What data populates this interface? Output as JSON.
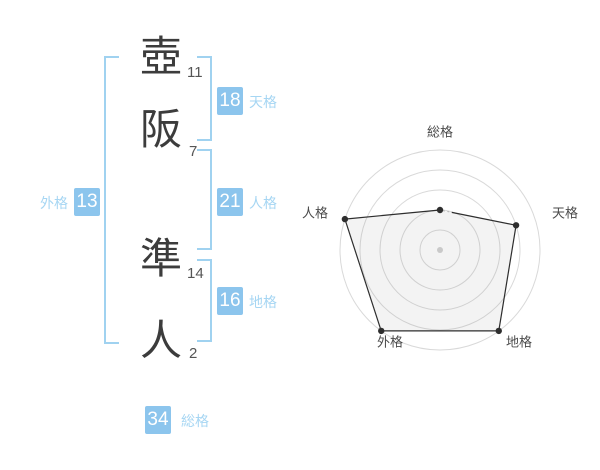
{
  "colors": {
    "accent": "#8cc5ed",
    "accent-light": "#a6d6f3",
    "bracket": "#a0d2f0",
    "ink": "#3c3c3c",
    "stroke-gray": "#555555",
    "axis-label": "#4a4a4a"
  },
  "name_analysis": {
    "characters": [
      {
        "char": "壺",
        "strokes": "11"
      },
      {
        "char": "阪",
        "strokes": "7"
      },
      {
        "char": "準",
        "strokes": "14"
      },
      {
        "char": "人",
        "strokes": "2"
      }
    ],
    "categories": {
      "tenkaku": {
        "value": "18",
        "label": "天格"
      },
      "jinkaku": {
        "value": "21",
        "label": "人格"
      },
      "chikaku": {
        "value": "16",
        "label": "地格"
      },
      "gaikaku": {
        "value": "13",
        "label": "外格"
      },
      "soukaku": {
        "value": "34",
        "label": "総格"
      }
    }
  },
  "chart_data": {
    "type": "radar",
    "categories": [
      "総格",
      "天格",
      "地格",
      "外格",
      "人格"
    ],
    "values": [
      2,
      4,
      5,
      5,
      5
    ],
    "max": 5,
    "rings": 5,
    "start": "top",
    "direction": "clockwise",
    "grid": true,
    "legend": "none",
    "broken_edge_index": 0,
    "grid_color": "#d9d9d9",
    "series_color": "#2e2e2e",
    "fill_color": "rgba(140,140,140,0.10)",
    "center_dot_color": "#c9c9c9"
  }
}
